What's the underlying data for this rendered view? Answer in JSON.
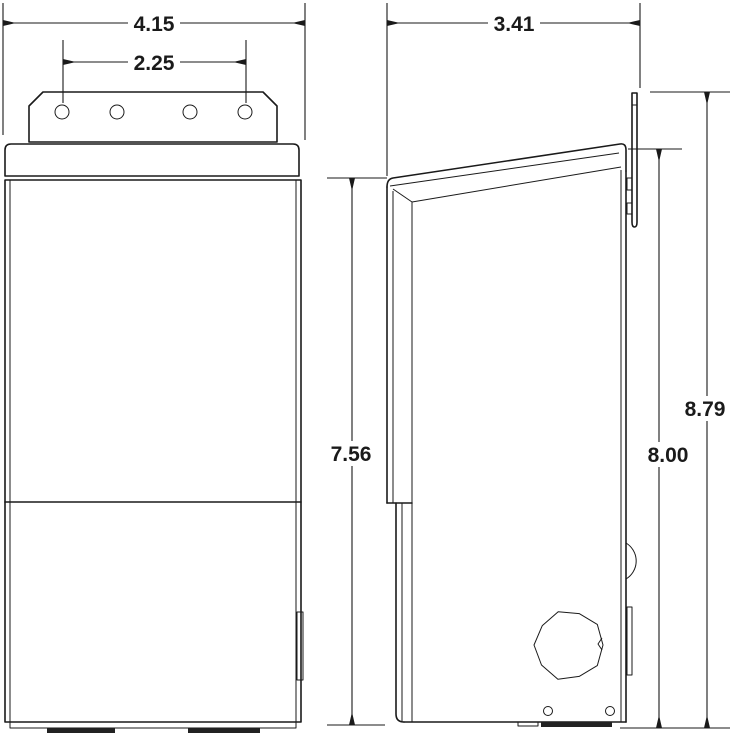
{
  "drawing": {
    "type": "technical-dimension-drawing",
    "colors": {
      "line": "#1a1a1a",
      "background": "#ffffff"
    },
    "dimensions": {
      "front_width": {
        "value": "4.15"
      },
      "hole_spacing": {
        "value": "2.25"
      },
      "depth": {
        "value": "3.41"
      },
      "front_height": {
        "value": "7.56"
      },
      "body_height": {
        "value": "8.00"
      },
      "overall_height": {
        "value": "8.79"
      }
    }
  }
}
